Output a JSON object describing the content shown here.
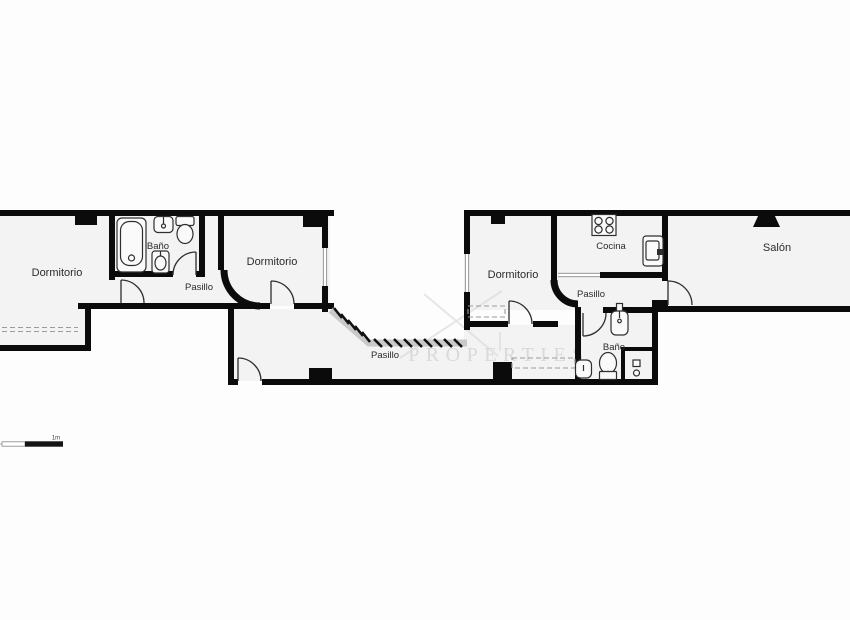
{
  "floorplan": {
    "rooms": {
      "dormitorio_left": "Dormitorio",
      "banio_left": "Baño",
      "pasillo_left": "Pasillo",
      "dormitorio_middle": "Dormitorio",
      "pasillo_main": "Pasillo",
      "dormitorio_right": "Dormitorio",
      "cocina": "Cocina",
      "pasillo_right": "Pasillo",
      "banio_right": "Baño",
      "salon": "Salón"
    },
    "fixtures": [
      "bathtub-icon",
      "sink-icon",
      "toilet-icon",
      "bidet-icon",
      "stove-icon",
      "kitchen-sink-icon",
      "shower-icon"
    ],
    "watermark": {
      "text": "PROPERTIES"
    },
    "scale_bar": {
      "label": "1m"
    },
    "colors": {
      "wall": "#0b0b0b",
      "room_fill": "#f3f3f3",
      "background": "#fdfdfd",
      "dashed": "#9b9b9b",
      "watermark": "#c8c8c8",
      "label_text": "#2b2b2b"
    }
  }
}
